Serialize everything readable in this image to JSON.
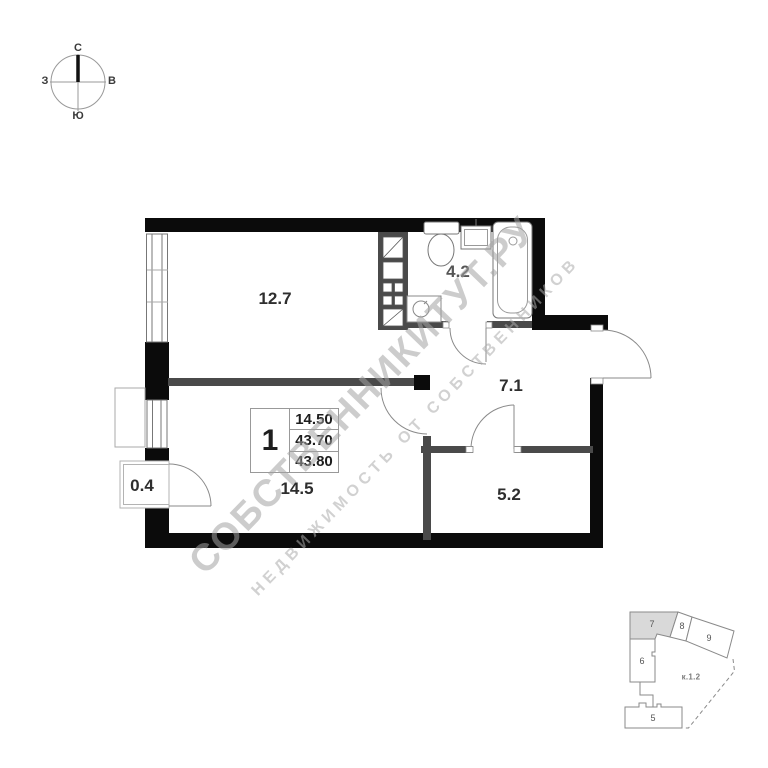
{
  "compass": {
    "north": "С",
    "east": "В",
    "south": "Ю",
    "west": "З"
  },
  "plan": {
    "rooms": {
      "living": "12.7",
      "bathroom": "4.2",
      "hallway": "7.1",
      "pantry": "5.2",
      "kitchen_living": "14.5",
      "balcony": "0.4"
    },
    "summary": {
      "rooms_count": "1",
      "rows": [
        "14.50",
        "43.70",
        "43.80"
      ]
    }
  },
  "watermark": {
    "line1": "СОБСТВЕННИКИТУТ.РУ",
    "line2": "НЕДВИЖИМОСТЬ ОТ СОБСТВЕННИКОВ"
  },
  "site_plan": {
    "building_label": "к.1.2",
    "sections": {
      "s5": "5",
      "s6": "6",
      "s7": "7",
      "s8": "8",
      "s9": "9"
    }
  },
  "colors": {
    "wall": "#0b0b0b",
    "interior_wall": "#4a4a4a",
    "line": "#8a8a8a",
    "highlight_section": "#d9d9d9",
    "watermark": "#aaaaaa"
  }
}
